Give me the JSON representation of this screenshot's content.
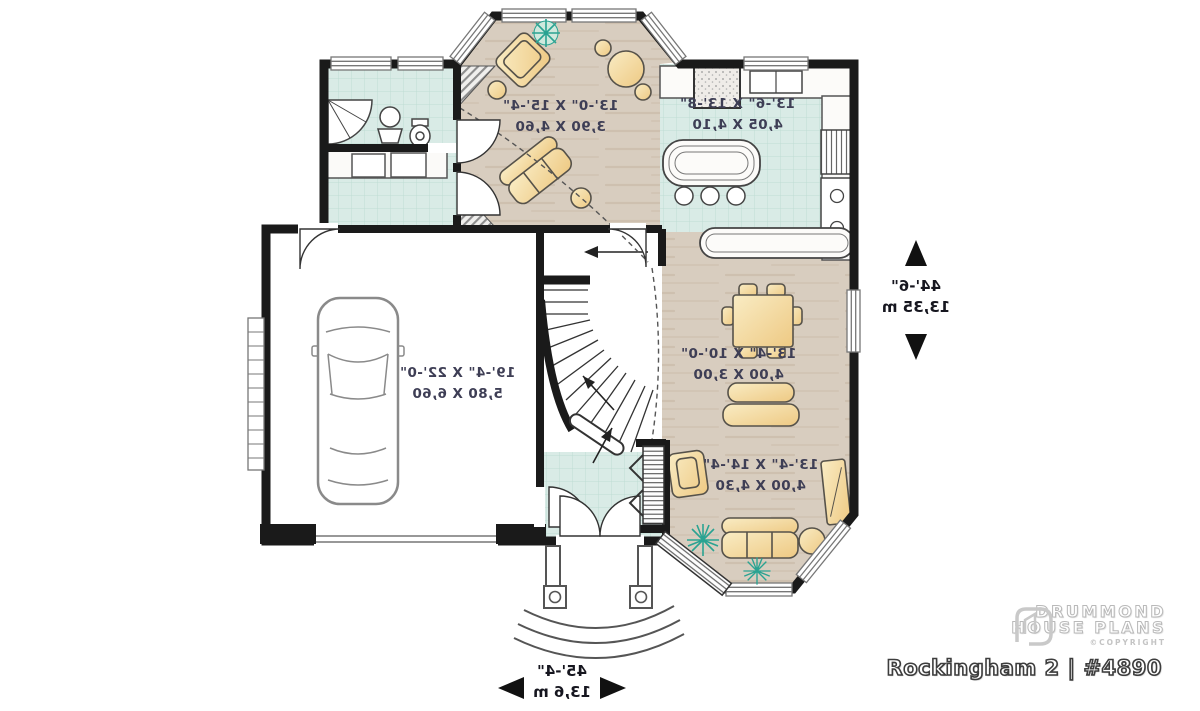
{
  "title": "Rockingham 2 | #4890",
  "logo": {
    "name_line1": "DRUMMOND",
    "name_line2": "HOUSE PLANS",
    "copyright": "©COPYRIGHT"
  },
  "rooms": {
    "family_room": {
      "imperial": "13'-0\" X 15'-4\"",
      "metric": "3,90 X 4,60"
    },
    "kitchen": {
      "imperial": "13'-6\" X 13'-8\"",
      "metric": "4,05 X 4,10"
    },
    "dining_room": {
      "imperial": "13'-4\" X 10'-0\"",
      "metric": "4,00 X 3,00"
    },
    "living_room": {
      "imperial": "13'-4\" X 14'-4\"",
      "metric": "4,00 X 4,30"
    },
    "garage": {
      "imperial": "19'-4\" X 22'-0\"",
      "metric": "5,80 X 6,60"
    }
  },
  "overall_dimensions": {
    "depth": {
      "imperial": "44'-6\"",
      "metric": "13,35 m"
    },
    "width": {
      "imperial": "45'-4\"",
      "metric": "13,6 m"
    }
  },
  "colors": {
    "wall": "#1a1a1a",
    "tile_floor": "#d9ebe6",
    "wood_floor": "#d8cdbf",
    "furniture": "#f3dfa9",
    "plant": "#2aa392",
    "label_text": "#3e3e55"
  }
}
